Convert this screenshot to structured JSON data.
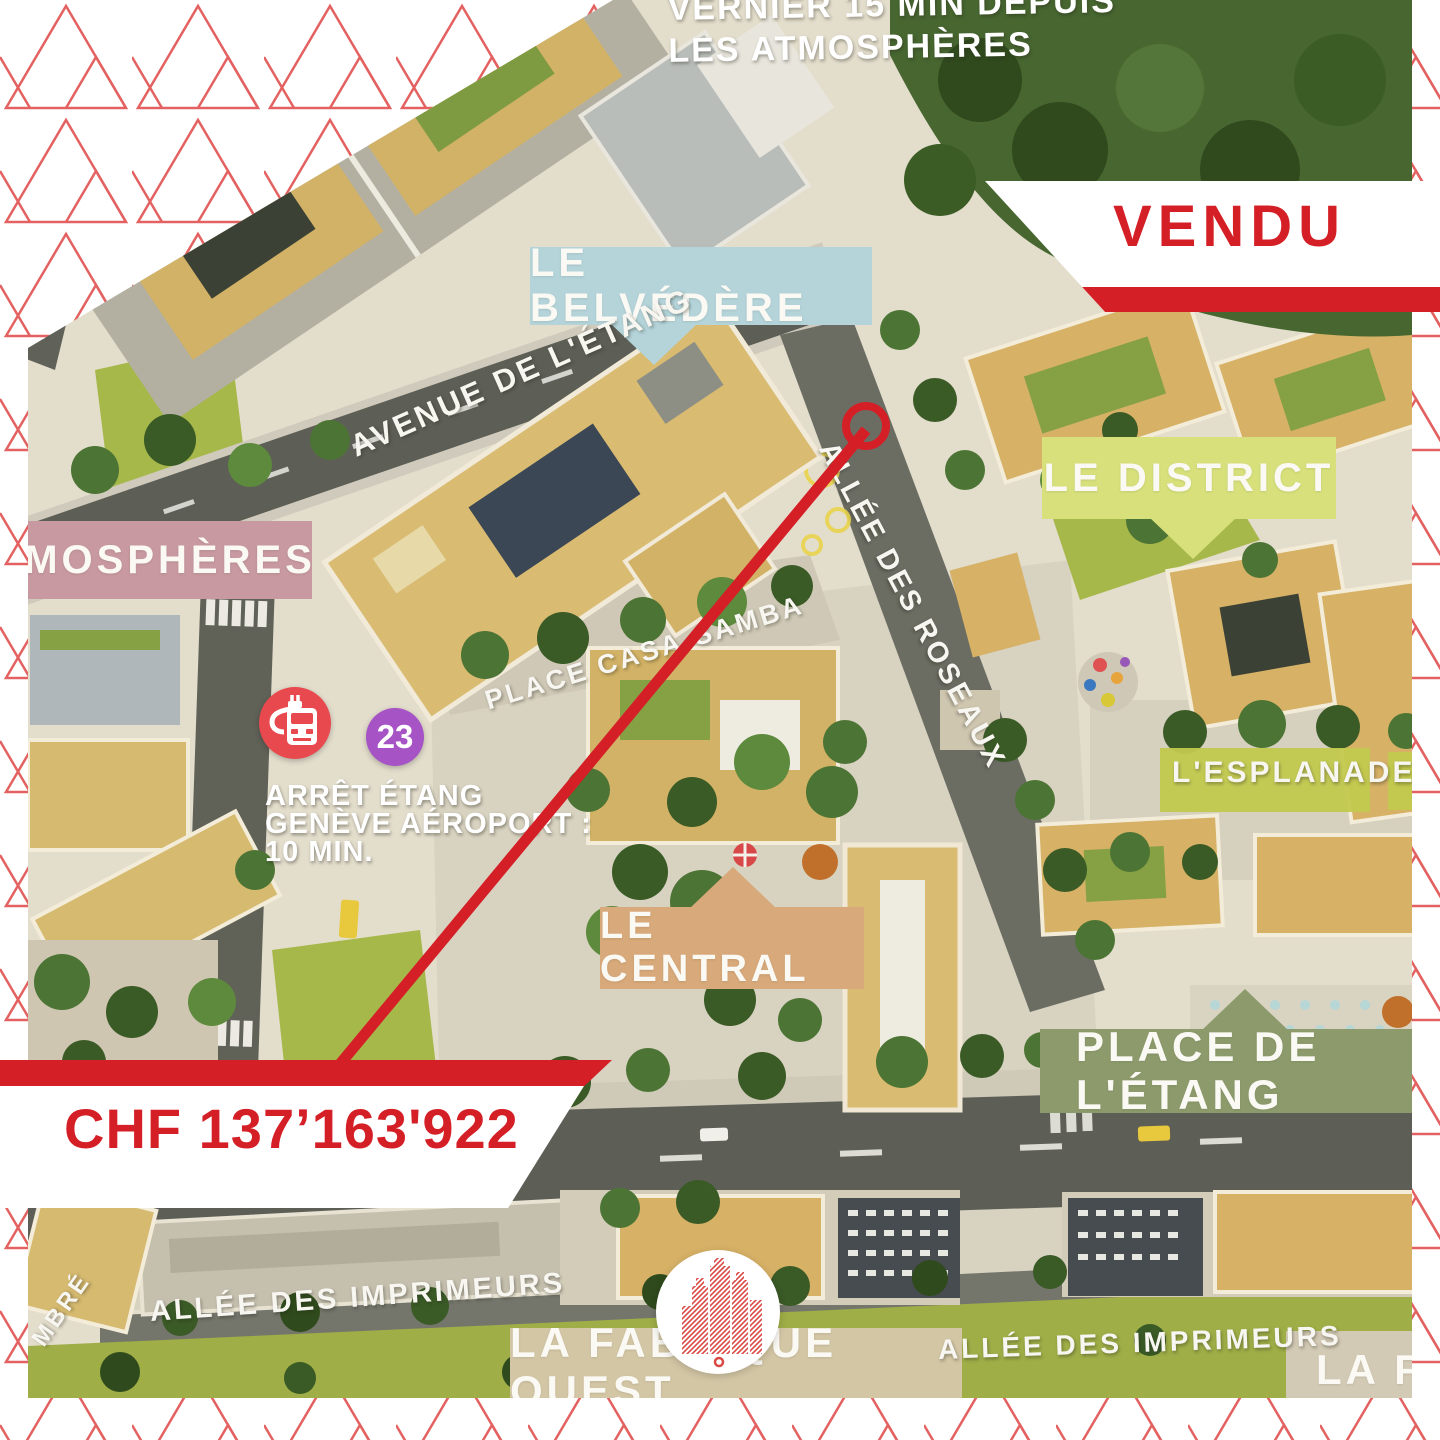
{
  "frame": {
    "pattern_color": "#e0514f",
    "background": "#ffffff"
  },
  "banners": {
    "red": "#d51f26",
    "vendu_label": "VENDU",
    "price_label": "CHF 137’163'922"
  },
  "top_caption": {
    "line1": "VERNIER 15 MIN DEPUIS",
    "line2": "LES ATMOSPHÈRES"
  },
  "tags": {
    "belvedere": {
      "label": "LE BELVÉDÈRE",
      "color": "#b4d4da"
    },
    "district": {
      "label": "LE DISTRICT",
      "color": "#d7e07b"
    },
    "atmospheres": {
      "label": "MOSPHÈRES",
      "color": "#c899a0"
    },
    "central": {
      "label": "LE CENTRAL",
      "color": "#d8a97a"
    },
    "place_etang": {
      "label": "PLACE DE L'ÉTANG",
      "color": "#8d9b6c"
    },
    "fabrique_ouest": {
      "label": "LA FABRIQUE OUEST",
      "color": "#d3c6a5"
    },
    "fabrique_partial": {
      "label": "LA FA",
      "color": "#d3cab5"
    }
  },
  "streets": {
    "avenue_etang": "AVENUE DE L'ÉTANG",
    "rue_etang_partial": "DE L'ÉTANG",
    "casa_samba": "PLACE CASA-SAMBA",
    "roseaux": "ALLÉE DES ROSEAUX",
    "esplanade": "L'ESPLANADE",
    "imprimeurs_left": "ALLÉE DES IMPRIMEURS",
    "imprimeurs_right": "ALLÉE DES IMPRIMEURS",
    "nenuphars_partial": "NÉNUPHA",
    "ombre_partial": "MBRÉ"
  },
  "transit": {
    "badge_number": "23",
    "badge_color": "#a653c6",
    "bus_circle_color": "#e8494e",
    "stop_line1": "ARRÊT ÉTANG",
    "stop_line2": "GENÈVE AÉROPORT :",
    "stop_line3": "10 MIN."
  }
}
